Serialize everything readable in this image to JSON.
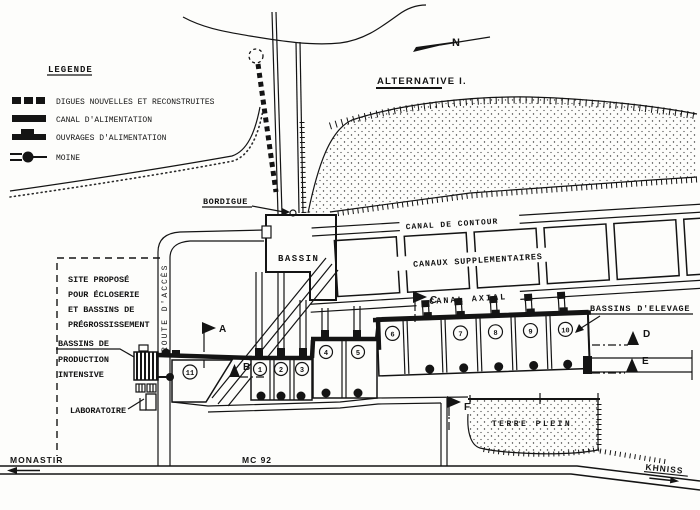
{
  "legend": {
    "title": "LEGENDE",
    "items": [
      {
        "icon": "dashed-dike-symbol",
        "label": "DIGUES NOUVELLES ET RECONSTRUITES"
      },
      {
        "icon": "solid-canal-symbol",
        "label": "CANAL D'ALIMENTATION"
      },
      {
        "icon": "intake-structure-symbol",
        "label": "OUVRAGES D'ALIMENTATION"
      },
      {
        "icon": "moine-symbol",
        "label": "MOINE"
      }
    ]
  },
  "compass": {
    "north": "N"
  },
  "labels": {
    "alternative": "ALTERNATIVE I.",
    "bordigue": "BORDIGUE",
    "bassin": "BASSIN",
    "canal_contour": "CANAL DE CONTOUR",
    "canaux_supp": "CANAUX SUPPLEMENTAIRES",
    "canal_axial": "CANAL AXIAL",
    "bassins_elevage": "BASSINS D'ELEVAGE",
    "terre_plein": "TERRE PLEIN",
    "route_acces": "ROUTE D'ACCÈS",
    "laboratoire": "LABORATOIRE"
  },
  "site_note_lines": [
    "SITE PROPOSÉ",
    "POUR ÉCLOSERIE",
    "ET BASSINS DE",
    "PRÉGROSSISSEMENT"
  ],
  "production_lines": [
    "BASSINS DE",
    "PRODUCTION",
    "INTENSIVE"
  ],
  "basin_numbers": [
    "1",
    "2",
    "3",
    "4",
    "5",
    "6",
    "7",
    "8",
    "9",
    "10",
    "11"
  ],
  "section_markers": [
    "A",
    "B",
    "C",
    "D",
    "E",
    "F"
  ],
  "roads": {
    "west": "MONASTIR",
    "route": "MC 92",
    "east": "KHNISS"
  }
}
